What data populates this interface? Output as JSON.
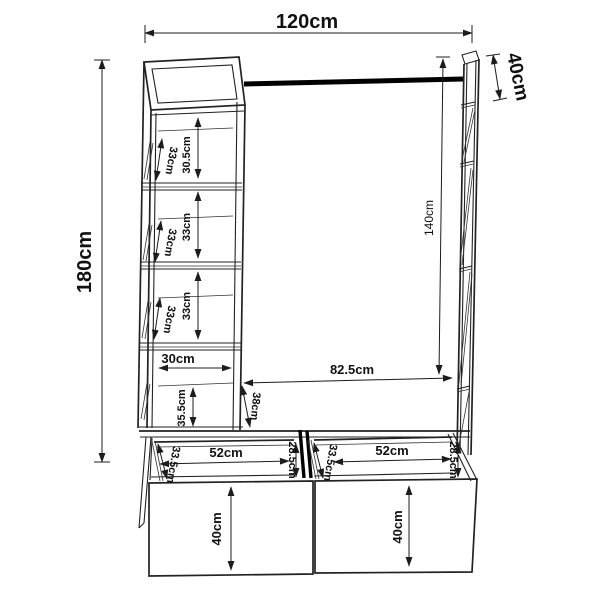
{
  "drawing": {
    "description": "Technical dimension drawing of a wardrobe rack with shelf tower, hanging rail, bench top and two drawers",
    "unit": "cm",
    "overall": {
      "width": "120cm",
      "depth": "40cm",
      "height": "180cm",
      "rod_height": "140cm"
    },
    "tower": {
      "compartments": [
        {
          "depth": "33cm",
          "height": "30.5cm"
        },
        {
          "depth": "33cm",
          "height": "33cm"
        },
        {
          "depth": "33cm",
          "height": "33cm"
        },
        {
          "width": "30cm",
          "height": "35.5cm"
        }
      ]
    },
    "bench": {
      "width": "82.5cm",
      "depth": "38cm"
    },
    "drawers": {
      "left": {
        "width": "52cm",
        "depth": "33.5cm",
        "opening_height": "28.5cm",
        "front_height": "40cm"
      },
      "right": {
        "width": "52cm",
        "depth": "33.5cm",
        "opening_height": "28.5cm",
        "front_height": "40cm"
      }
    }
  },
  "colors": {
    "background": "#ffffff",
    "line": "#222222",
    "rod": "#000000"
  }
}
